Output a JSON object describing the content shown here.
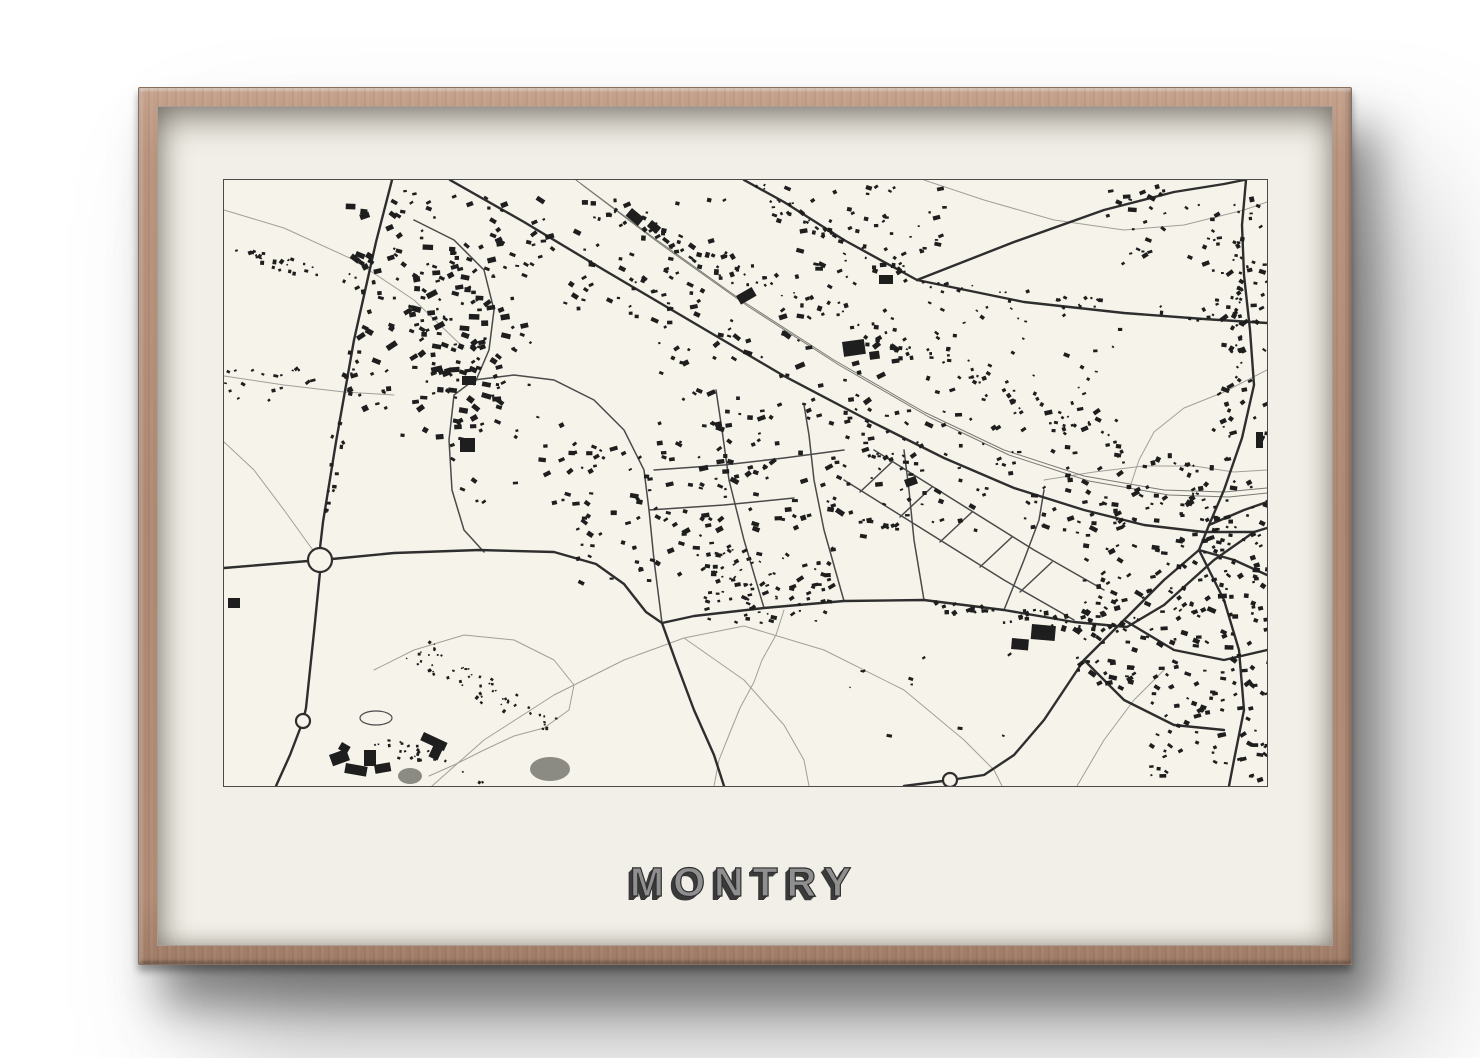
{
  "poster": {
    "title": "MONTRY",
    "colors": {
      "frame_wood": "#b08b75",
      "mat": "#f1efe7",
      "paper": "#f6f3ea",
      "ink": "#1e1e1e",
      "road_dark": "#2e2e2e",
      "road_mid": "#4a4a4a",
      "road_thin": "#a0a099",
      "rail": "#7a7a74",
      "map_border": "#4a4a4a",
      "pond": "#8b8b83",
      "title_fill": "#8f8f8f",
      "title_shadow": "#3b3b3b"
    }
  },
  "map_features": {
    "roads_dark": [
      [
        [
          168,
          0
        ],
        [
          152,
          62
        ],
        [
          130,
          160
        ],
        [
          112,
          262
        ],
        [
          99,
          342
        ],
        [
          96,
          368
        ],
        [
          96,
          392
        ],
        [
          90,
          452
        ],
        [
          82,
          528
        ],
        [
          79,
          541
        ],
        [
          66,
          575
        ],
        [
          52,
          606
        ]
      ],
      [
        [
          0,
          388
        ],
        [
          48,
          384
        ],
        [
          84,
          381
        ],
        [
          108,
          379
        ],
        [
          170,
          373
        ],
        [
          255,
          370
        ],
        [
          330,
          372
        ],
        [
          372,
          384
        ],
        [
          400,
          404
        ],
        [
          422,
          432
        ],
        [
          438,
          443
        ],
        [
          470,
          436
        ],
        [
          540,
          428
        ],
        [
          620,
          421
        ],
        [
          700,
          420
        ],
        [
          780,
          430
        ],
        [
          850,
          442
        ],
        [
          903,
          447
        ],
        [
          940,
          425
        ],
        [
          990,
          380
        ],
        [
          1030,
          352
        ],
        [
          1043,
          348
        ]
      ],
      [
        [
          438,
          443
        ],
        [
          452,
          482
        ],
        [
          470,
          530
        ],
        [
          490,
          575
        ],
        [
          500,
          606
        ]
      ],
      [
        [
          226,
          0
        ],
        [
          300,
          42
        ],
        [
          380,
          90
        ],
        [
          470,
          143
        ],
        [
          560,
          196
        ],
        [
          640,
          238
        ],
        [
          720,
          278
        ],
        [
          790,
          308
        ],
        [
          860,
          330
        ],
        [
          920,
          345
        ],
        [
          980,
          352
        ],
        [
          1030,
          352
        ]
      ],
      [
        [
          520,
          0
        ],
        [
          560,
          22
        ],
        [
          620,
          60
        ],
        [
          693,
          100
        ]
      ],
      [
        [
          693,
          100
        ],
        [
          790,
          62
        ],
        [
          880,
          30
        ],
        [
          950,
          12
        ],
        [
          1000,
          4
        ],
        [
          1020,
          0
        ]
      ],
      [
        [
          693,
          100
        ],
        [
          800,
          122
        ],
        [
          900,
          133
        ],
        [
          980,
          139
        ],
        [
          1043,
          143
        ]
      ],
      [
        [
          1022,
          0
        ],
        [
          1018,
          45
        ],
        [
          1020,
          95
        ],
        [
          1026,
          150
        ],
        [
          1030,
          205
        ],
        [
          1018,
          258
        ],
        [
          1000,
          310
        ],
        [
          985,
          345
        ],
        [
          975,
          370
        ]
      ],
      [
        [
          975,
          370
        ],
        [
          940,
          400
        ],
        [
          900,
          440
        ],
        [
          860,
          480
        ],
        [
          820,
          540
        ],
        [
          790,
          575
        ],
        [
          760,
          595
        ],
        [
          733,
          599
        ]
      ],
      [
        [
          975,
          370
        ],
        [
          1000,
          420
        ],
        [
          1015,
          470
        ],
        [
          1020,
          530
        ],
        [
          1010,
          580
        ],
        [
          1005,
          606
        ]
      ],
      [
        [
          975,
          370
        ],
        [
          1010,
          380
        ],
        [
          1043,
          395
        ]
      ],
      [
        [
          900,
          440
        ],
        [
          950,
          470
        ],
        [
          1000,
          480
        ],
        [
          1043,
          470
        ]
      ],
      [
        [
          860,
          480
        ],
        [
          900,
          520
        ],
        [
          950,
          545
        ],
        [
          1000,
          550
        ]
      ],
      [
        [
          985,
          345
        ],
        [
          1020,
          330
        ],
        [
          1043,
          322
        ]
      ],
      [
        [
          719,
          601
        ],
        [
          680,
          606
        ]
      ]
    ],
    "roads_mid": [
      [
        [
          540,
          428
        ],
        [
          520,
          360
        ],
        [
          505,
          300
        ],
        [
          498,
          250
        ],
        [
          492,
          210
        ]
      ],
      [
        [
          620,
          421
        ],
        [
          600,
          350
        ],
        [
          590,
          300
        ],
        [
          585,
          255
        ],
        [
          580,
          225
        ]
      ],
      [
        [
          700,
          420
        ],
        [
          690,
          360
        ],
        [
          685,
          310
        ],
        [
          680,
          270
        ]
      ],
      [
        [
          438,
          443
        ],
        [
          430,
          380
        ],
        [
          425,
          330
        ],
        [
          420,
          290
        ],
        [
          400,
          250
        ],
        [
          370,
          220
        ],
        [
          330,
          200
        ],
        [
          290,
          195
        ],
        [
          250,
          200
        ],
        [
          230,
          215
        ],
        [
          225,
          260
        ],
        [
          228,
          310
        ],
        [
          240,
          350
        ],
        [
          260,
          372
        ]
      ],
      [
        [
          780,
          430
        ],
        [
          800,
          380
        ],
        [
          815,
          340
        ],
        [
          820,
          310
        ]
      ],
      [
        [
          620,
          300
        ],
        [
          700,
          350
        ],
        [
          780,
          400
        ],
        [
          850,
          440
        ]
      ],
      [
        [
          650,
          270
        ],
        [
          730,
          320
        ],
        [
          810,
          370
        ],
        [
          880,
          410
        ]
      ],
      [
        [
          636,
          312
        ],
        [
          668,
          282
        ]
      ],
      [
        [
          676,
          337
        ],
        [
          708,
          307
        ]
      ],
      [
        [
          716,
          362
        ],
        [
          748,
          332
        ]
      ],
      [
        [
          756,
          387
        ],
        [
          788,
          357
        ]
      ],
      [
        [
          796,
          412
        ],
        [
          828,
          382
        ]
      ],
      [
        [
          190,
          40
        ],
        [
          230,
          60
        ],
        [
          260,
          90
        ],
        [
          270,
          130
        ],
        [
          265,
          170
        ],
        [
          250,
          205
        ]
      ],
      [
        [
          430,
          290
        ],
        [
          500,
          285
        ],
        [
          560,
          278
        ],
        [
          620,
          270
        ]
      ],
      [
        [
          425,
          330
        ],
        [
          500,
          325
        ],
        [
          570,
          318
        ]
      ]
    ],
    "roads_thin": [
      [
        [
          0,
          30
        ],
        [
          60,
          48
        ],
        [
          130,
          80
        ],
        [
          190,
          120
        ],
        [
          240,
          168
        ]
      ],
      [
        [
          0,
          196
        ],
        [
          60,
          205
        ],
        [
          120,
          212
        ],
        [
          170,
          215
        ]
      ],
      [
        [
          560,
          430
        ],
        [
          552,
          455
        ],
        [
          538,
          480
        ],
        [
          530,
          502
        ],
        [
          516,
          528
        ],
        [
          505,
          555
        ],
        [
          495,
          580
        ],
        [
          490,
          606
        ]
      ],
      [
        [
          208,
          606
        ],
        [
          260,
          560
        ],
        [
          330,
          515
        ],
        [
          400,
          480
        ],
        [
          460,
          458
        ],
        [
          520,
          446
        ]
      ],
      [
        [
          520,
          446
        ],
        [
          600,
          470
        ],
        [
          680,
          510
        ],
        [
          740,
          560
        ],
        [
          770,
          590
        ],
        [
          778,
          606
        ]
      ],
      [
        [
          460,
          458
        ],
        [
          520,
          500
        ],
        [
          560,
          545
        ],
        [
          580,
          580
        ],
        [
          585,
          606
        ]
      ],
      [
        [
          853,
          606
        ],
        [
          880,
          560
        ],
        [
          910,
          520
        ],
        [
          940,
          490
        ]
      ],
      [
        [
          700,
          0
        ],
        [
          760,
          20
        ],
        [
          830,
          40
        ],
        [
          900,
          50
        ],
        [
          960,
          45
        ],
        [
          1020,
          30
        ],
        [
          1043,
          22
        ]
      ],
      [
        [
          1043,
          190
        ],
        [
          1000,
          212
        ],
        [
          960,
          228
        ],
        [
          930,
          252
        ],
        [
          915,
          280
        ],
        [
          905,
          310
        ]
      ],
      [
        [
          96,
          380
        ],
        [
          60,
          330
        ],
        [
          30,
          290
        ],
        [
          0,
          262
        ]
      ],
      [
        [
          150,
          490
        ],
        [
          190,
          470
        ],
        [
          240,
          455
        ],
        [
          290,
          460
        ],
        [
          330,
          480
        ],
        [
          350,
          505
        ],
        [
          345,
          530
        ],
        [
          320,
          548
        ],
        [
          290,
          556
        ],
        [
          260,
          570
        ],
        [
          230,
          585
        ],
        [
          205,
          596
        ]
      ],
      [
        [
          820,
          300
        ],
        [
          870,
          292
        ],
        [
          920,
          286
        ],
        [
          970,
          286
        ],
        [
          1010,
          292
        ],
        [
          1043,
          290
        ]
      ]
    ],
    "rails": [
      [
        [
          352,
          0
        ],
        [
          430,
          58
        ],
        [
          520,
          122
        ],
        [
          610,
          180
        ],
        [
          700,
          232
        ],
        [
          780,
          270
        ],
        [
          860,
          296
        ],
        [
          940,
          310
        ],
        [
          1000,
          312
        ],
        [
          1043,
          308
        ]
      ],
      [
        [
          357,
          4
        ],
        [
          435,
          63
        ],
        [
          525,
          127
        ],
        [
          615,
          185
        ],
        [
          705,
          237
        ],
        [
          785,
          275
        ],
        [
          865,
          301
        ],
        [
          945,
          315
        ],
        [
          1005,
          317
        ],
        [
          1043,
          313
        ]
      ]
    ],
    "circles": [
      {
        "x": 96,
        "y": 380,
        "r": 12
      },
      {
        "x": 79,
        "y": 541,
        "r": 7
      },
      {
        "x": 726,
        "y": 600,
        "r": 7
      }
    ],
    "strips": [
      {
        "x1": 360,
        "y1": 20,
        "x2": 990,
        "y2": 305,
        "n": 130,
        "spread": 30,
        "s": 3
      },
      {
        "x1": 700,
        "y1": 425,
        "x2": 900,
        "y2": 448,
        "n": 40,
        "spread": 16,
        "s": 3
      },
      {
        "x1": 700,
        "y1": 105,
        "x2": 1035,
        "y2": 140,
        "n": 28,
        "spread": 12,
        "s": 2.5
      },
      {
        "x1": 1020,
        "y1": 10,
        "x2": 1002,
        "y2": 300,
        "n": 40,
        "spread": 14,
        "s": 3
      },
      {
        "x1": 190,
        "y1": 468,
        "x2": 330,
        "y2": 545,
        "n": 55,
        "spread": 26,
        "s": 2
      },
      {
        "x1": 5,
        "y1": 70,
        "x2": 150,
        "y2": 108,
        "n": 30,
        "spread": 16,
        "s": 2.5
      },
      {
        "x1": 128,
        "y1": 165,
        "x2": 100,
        "y2": 335,
        "n": 22,
        "spread": 12,
        "s": 3
      },
      {
        "x1": 150,
        "y1": 560,
        "x2": 260,
        "y2": 596,
        "n": 25,
        "spread": 16,
        "s": 2
      },
      {
        "x1": 525,
        "y1": 5,
        "x2": 685,
        "y2": 95,
        "n": 30,
        "spread": 18,
        "s": 2.6
      }
    ],
    "clusters": [
      {
        "x": 120,
        "y": 8,
        "w": 160,
        "h": 250,
        "n": 150,
        "s": 3.6
      },
      {
        "x": 195,
        "y": 55,
        "w": 115,
        "h": 155,
        "n": 70,
        "s": 3.2
      },
      {
        "x": 300,
        "y": 15,
        "w": 200,
        "h": 125,
        "n": 70,
        "s": 3
      },
      {
        "x": 430,
        "y": 130,
        "w": 240,
        "h": 225,
        "n": 150,
        "s": 3.2
      },
      {
        "x": 340,
        "y": 260,
        "w": 180,
        "h": 140,
        "n": 85,
        "s": 3
      },
      {
        "x": 480,
        "y": 365,
        "w": 130,
        "h": 78,
        "n": 90,
        "s": 2.5
      },
      {
        "x": 640,
        "y": 228,
        "w": 260,
        "h": 122,
        "n": 110,
        "s": 2.8
      },
      {
        "x": 545,
        "y": 5,
        "w": 175,
        "h": 100,
        "n": 60,
        "s": 2.8
      },
      {
        "x": 880,
        "y": 5,
        "w": 163,
        "h": 90,
        "n": 45,
        "s": 2.8
      },
      {
        "x": 988,
        "y": 60,
        "w": 55,
        "h": 200,
        "n": 40,
        "s": 2.8
      },
      {
        "x": 850,
        "y": 300,
        "w": 193,
        "h": 205,
        "n": 240,
        "s": 3
      },
      {
        "x": 925,
        "y": 500,
        "w": 118,
        "h": 100,
        "n": 65,
        "s": 2.8
      },
      {
        "x": 700,
        "y": 118,
        "w": 200,
        "h": 100,
        "n": 36,
        "s": 2.4
      },
      {
        "x": 225,
        "y": 228,
        "w": 125,
        "h": 95,
        "n": 22,
        "s": 2.8
      },
      {
        "x": 600,
        "y": 450,
        "w": 200,
        "h": 120,
        "n": 10,
        "s": 2
      },
      {
        "x": 0,
        "y": 185,
        "w": 90,
        "h": 40,
        "n": 18,
        "s": 2.4
      }
    ],
    "blobs": [
      [
        105,
        575,
        18,
        12,
        -20
      ],
      [
        122,
        583,
        22,
        10,
        10
      ],
      [
        140,
        570,
        12,
        16,
        0
      ],
      [
        118,
        562,
        10,
        8,
        30
      ],
      [
        150,
        585,
        16,
        9,
        -10
      ],
      [
        200,
        552,
        26,
        9,
        25
      ],
      [
        212,
        560,
        10,
        18,
        25
      ],
      [
        236,
        258,
        15,
        14,
        0
      ],
      [
        618,
        162,
        22,
        15,
        -8
      ],
      [
        645,
        172,
        10,
        8,
        -8
      ],
      [
        808,
        444,
        24,
        15,
        5
      ],
      [
        788,
        458,
        17,
        11,
        5
      ],
      [
        408,
        28,
        16,
        10,
        40
      ],
      [
        428,
        40,
        12,
        8,
        40
      ],
      [
        512,
        116,
        18,
        10,
        -30
      ],
      [
        238,
        196,
        14,
        9,
        0
      ],
      [
        1032,
        252,
        7,
        16,
        0
      ],
      [
        655,
        95,
        14,
        9,
        0
      ],
      [
        680,
        300,
        12,
        8,
        -20
      ],
      [
        4,
        418,
        12,
        10,
        0
      ]
    ],
    "ponds_gray": [
      {
        "cx": 326,
        "cy": 589,
        "rx": 20,
        "ry": 12
      },
      {
        "cx": 186,
        "cy": 596,
        "rx": 12,
        "ry": 8
      }
    ],
    "ponds_outline": [
      {
        "cx": 152,
        "cy": 538,
        "rx": 16,
        "ry": 7
      }
    ]
  }
}
